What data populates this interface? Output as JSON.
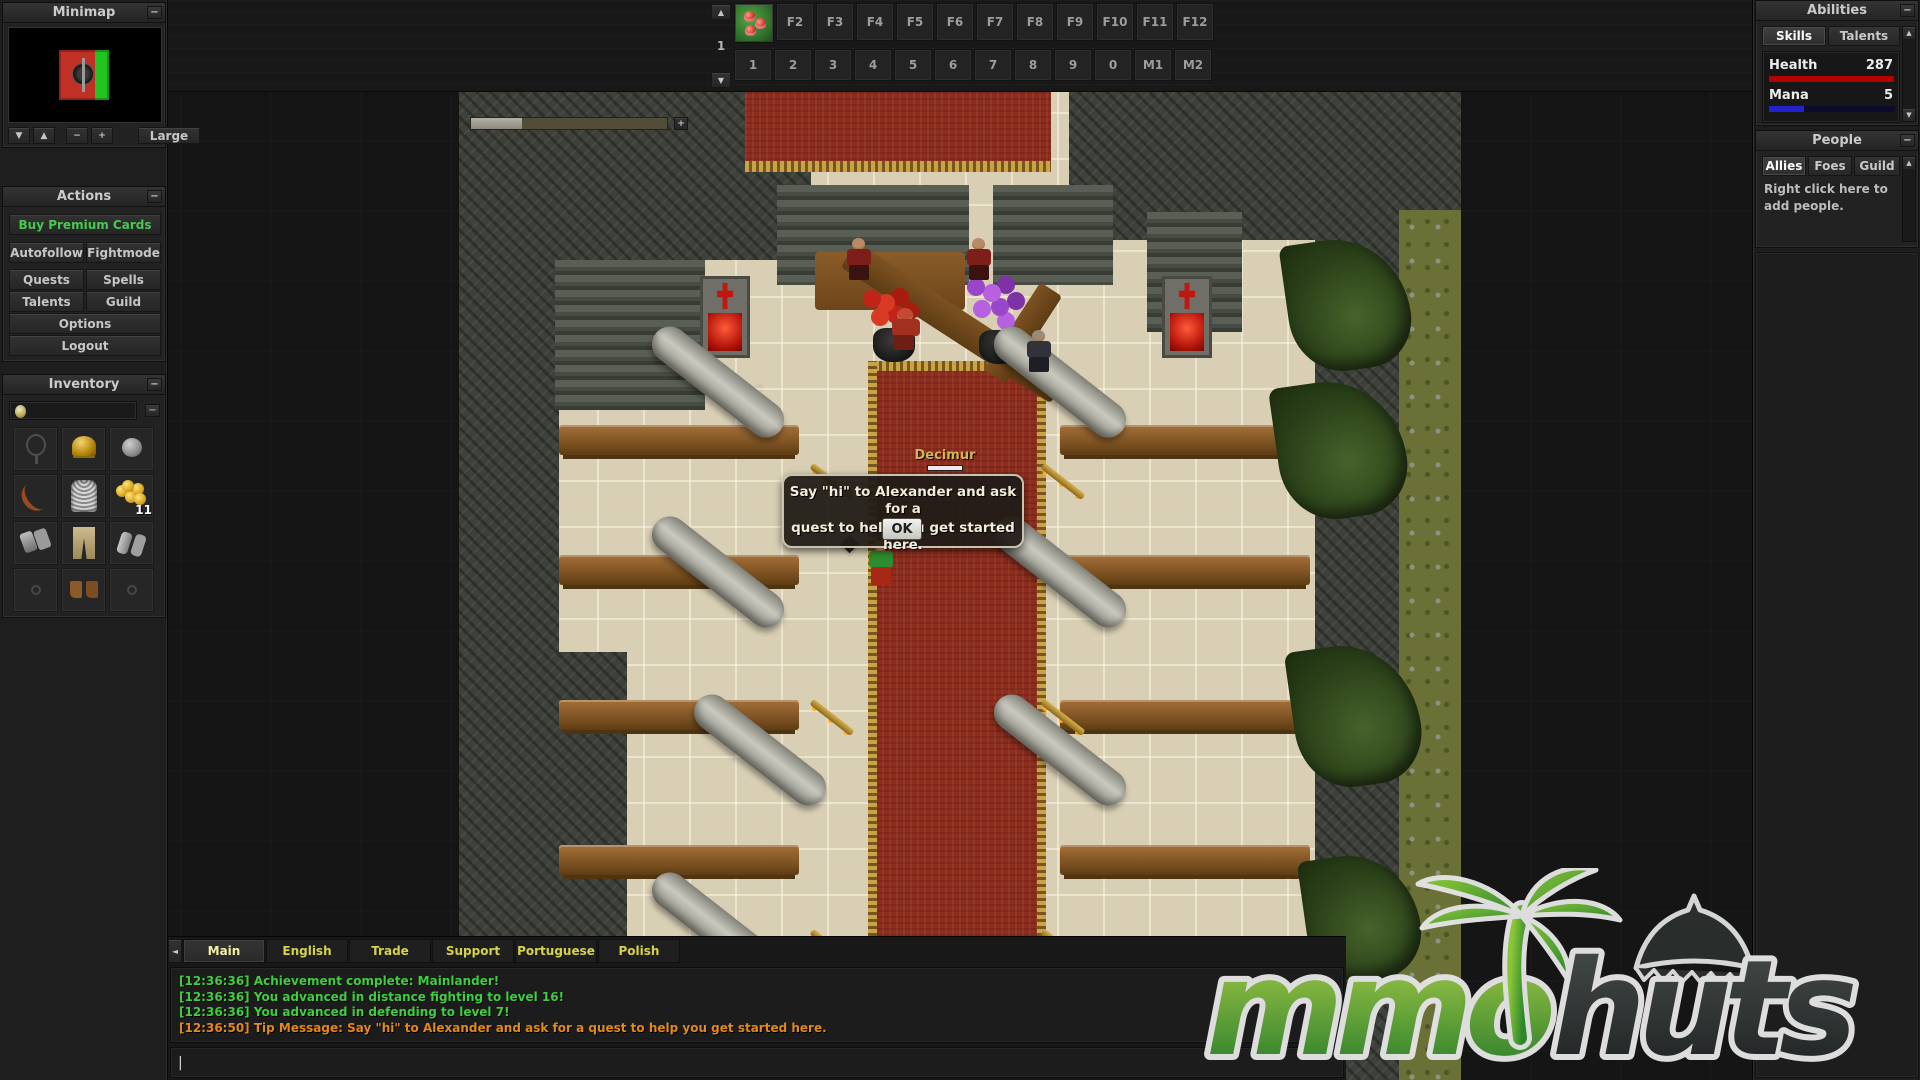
{
  "ui": {
    "collapse": "−",
    "plus": "+",
    "minus": "−",
    "up": "▲",
    "down": "▼",
    "left": "◄",
    "cursor": "|"
  },
  "minimap": {
    "title": "Minimap",
    "large_label": "Large"
  },
  "hotbar": {
    "group": "1",
    "first_slot_item": "red-mushrooms",
    "fkeys": [
      "F2",
      "F3",
      "F4",
      "F5",
      "F6",
      "F7",
      "F8",
      "F9",
      "F10",
      "F11",
      "F12"
    ],
    "numkeys": [
      "1",
      "2",
      "3",
      "4",
      "5",
      "6",
      "7",
      "8",
      "9",
      "0",
      "M1",
      "M2"
    ]
  },
  "actions": {
    "title": "Actions",
    "premium": "Buy Premium Cards",
    "autofollow": "Autofollow",
    "fightmode": "Fightmode",
    "quests": "Quests",
    "spells": "Spells",
    "talents": "Talents",
    "guild": "Guild",
    "options": "Options",
    "logout": "Logout"
  },
  "inventory": {
    "title": "Inventory",
    "coin_count": "11",
    "slots": [
      "necklace-slot",
      "helmet",
      "stone-ball",
      "bow",
      "chain-armor",
      "gold-coins",
      "gloves",
      "legs",
      "bracers",
      "ring-slot",
      "boots",
      "ring-slot"
    ]
  },
  "abilities": {
    "title": "Abilities",
    "tabs": {
      "skills": "Skills",
      "talents": "Talents"
    },
    "health_label": "Health",
    "health_value": "287",
    "health_color": "#b40000",
    "mana_label": "Mana",
    "mana_value": "5",
    "mana_color": "#2222cc"
  },
  "people": {
    "title": "People",
    "tabs": {
      "allies": "Allies",
      "foes": "Foes",
      "guild": "Guild"
    },
    "hint_line1": "Right click here to",
    "hint_line2": "add people."
  },
  "game": {
    "npc_name": "Decimur",
    "occluded_name": "Alex",
    "dialog_line1": "Say \"hi\" to Alexander and ask for a",
    "dialog_line2": "quest to help you get started here.",
    "ok_label": "OK"
  },
  "chat": {
    "tabs": [
      {
        "label": "Main",
        "active": true
      },
      {
        "label": "English",
        "active": false
      },
      {
        "label": "Trade",
        "active": false
      },
      {
        "label": "Support",
        "active": false
      },
      {
        "label": "Portuguese",
        "active": false
      },
      {
        "label": "Polish",
        "active": false
      }
    ],
    "messages": [
      {
        "time": "[12:36:36]",
        "text": "Achievement complete: Mainlander!",
        "color": "#3ecf3e"
      },
      {
        "time": "[12:36:36]",
        "text": "You advanced in distance fighting to level 16!",
        "color": "#3ecf3e"
      },
      {
        "time": "[12:36:36]",
        "text": "You advanced in defending to level 7!",
        "color": "#3ecf3e"
      },
      {
        "time": "[12:36:50]",
        "text": "Tip Message: Say \"hi\" to Alexander and ask for a quest to help you get started here.",
        "color": "#e2891b"
      }
    ]
  },
  "logo": {
    "part1": "mmo",
    "part2": "huts"
  }
}
